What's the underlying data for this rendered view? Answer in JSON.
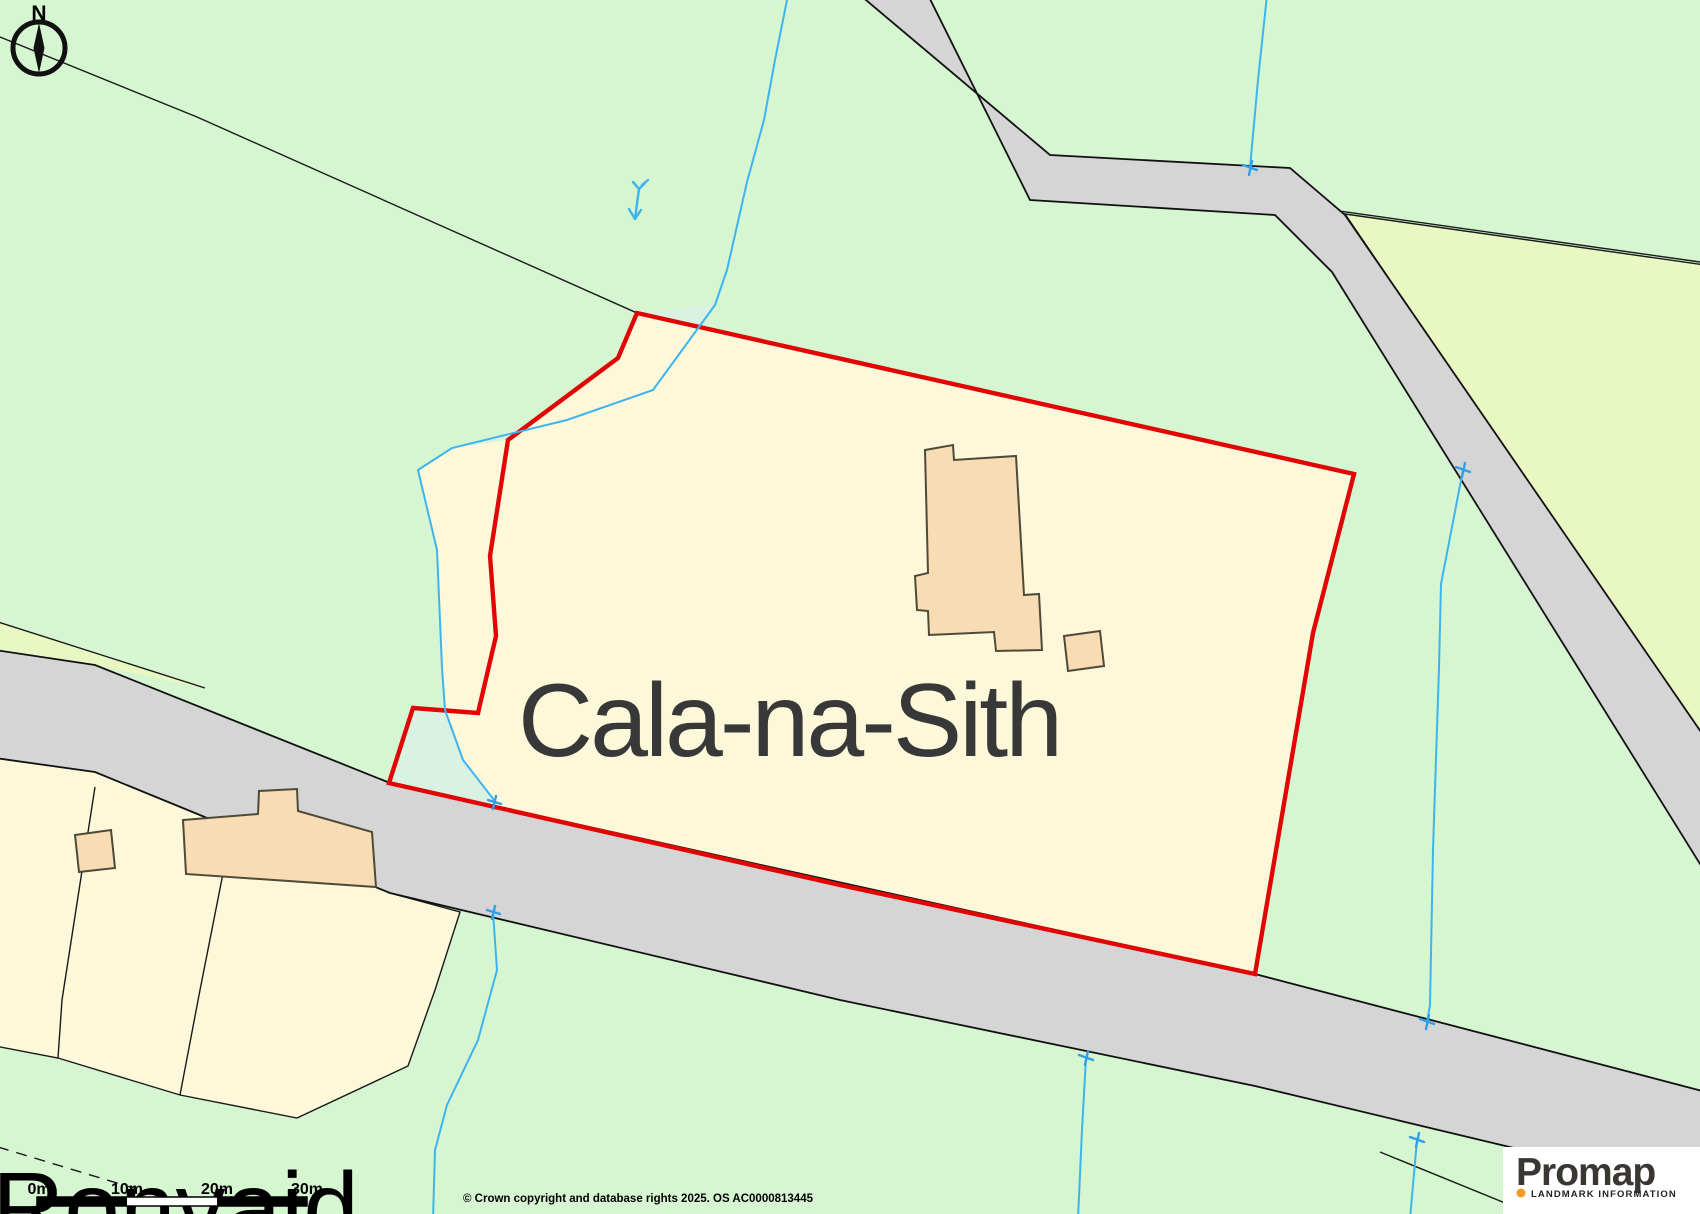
{
  "map": {
    "property_label": "Cala-na-Sith",
    "place_label_partial": "Ronvaid",
    "north_indicator": "N",
    "features": {
      "property_boundary": "red outline around Cala-na-Sith plot",
      "buildings": [
        "main house on plot",
        "small outbuilding on plot",
        "large building south-west of road",
        "small outbuilding south-west of road"
      ],
      "roads": [
        "main road crossing lower half",
        "road descending from top towards east edge"
      ],
      "water": [
        "stream through west of plot",
        "stream at east crossing upper road",
        "drain south of main road"
      ]
    },
    "colors": {
      "field_green": "#d6f5d1",
      "field_mint": "#d9f2e2",
      "plot_yellow": "#fdf8d9",
      "field_yellow_green": "#e9f8c3",
      "road_grey": "#d5d5d5",
      "building_tan": "#f7dcb4",
      "boundary_red": "#e10606",
      "water_blue": "#3eb4ef",
      "text_dark": "#383838"
    }
  },
  "scale_bar": {
    "labels": [
      "0m",
      "10m",
      "20m",
      "30m"
    ]
  },
  "attribution": "© Crown copyright and database rights 2025. OS AC0000813445",
  "logo": {
    "brand": "Promap",
    "tagline": "LANDMARK INFORMATION",
    "dot_color": "#f59a23"
  }
}
